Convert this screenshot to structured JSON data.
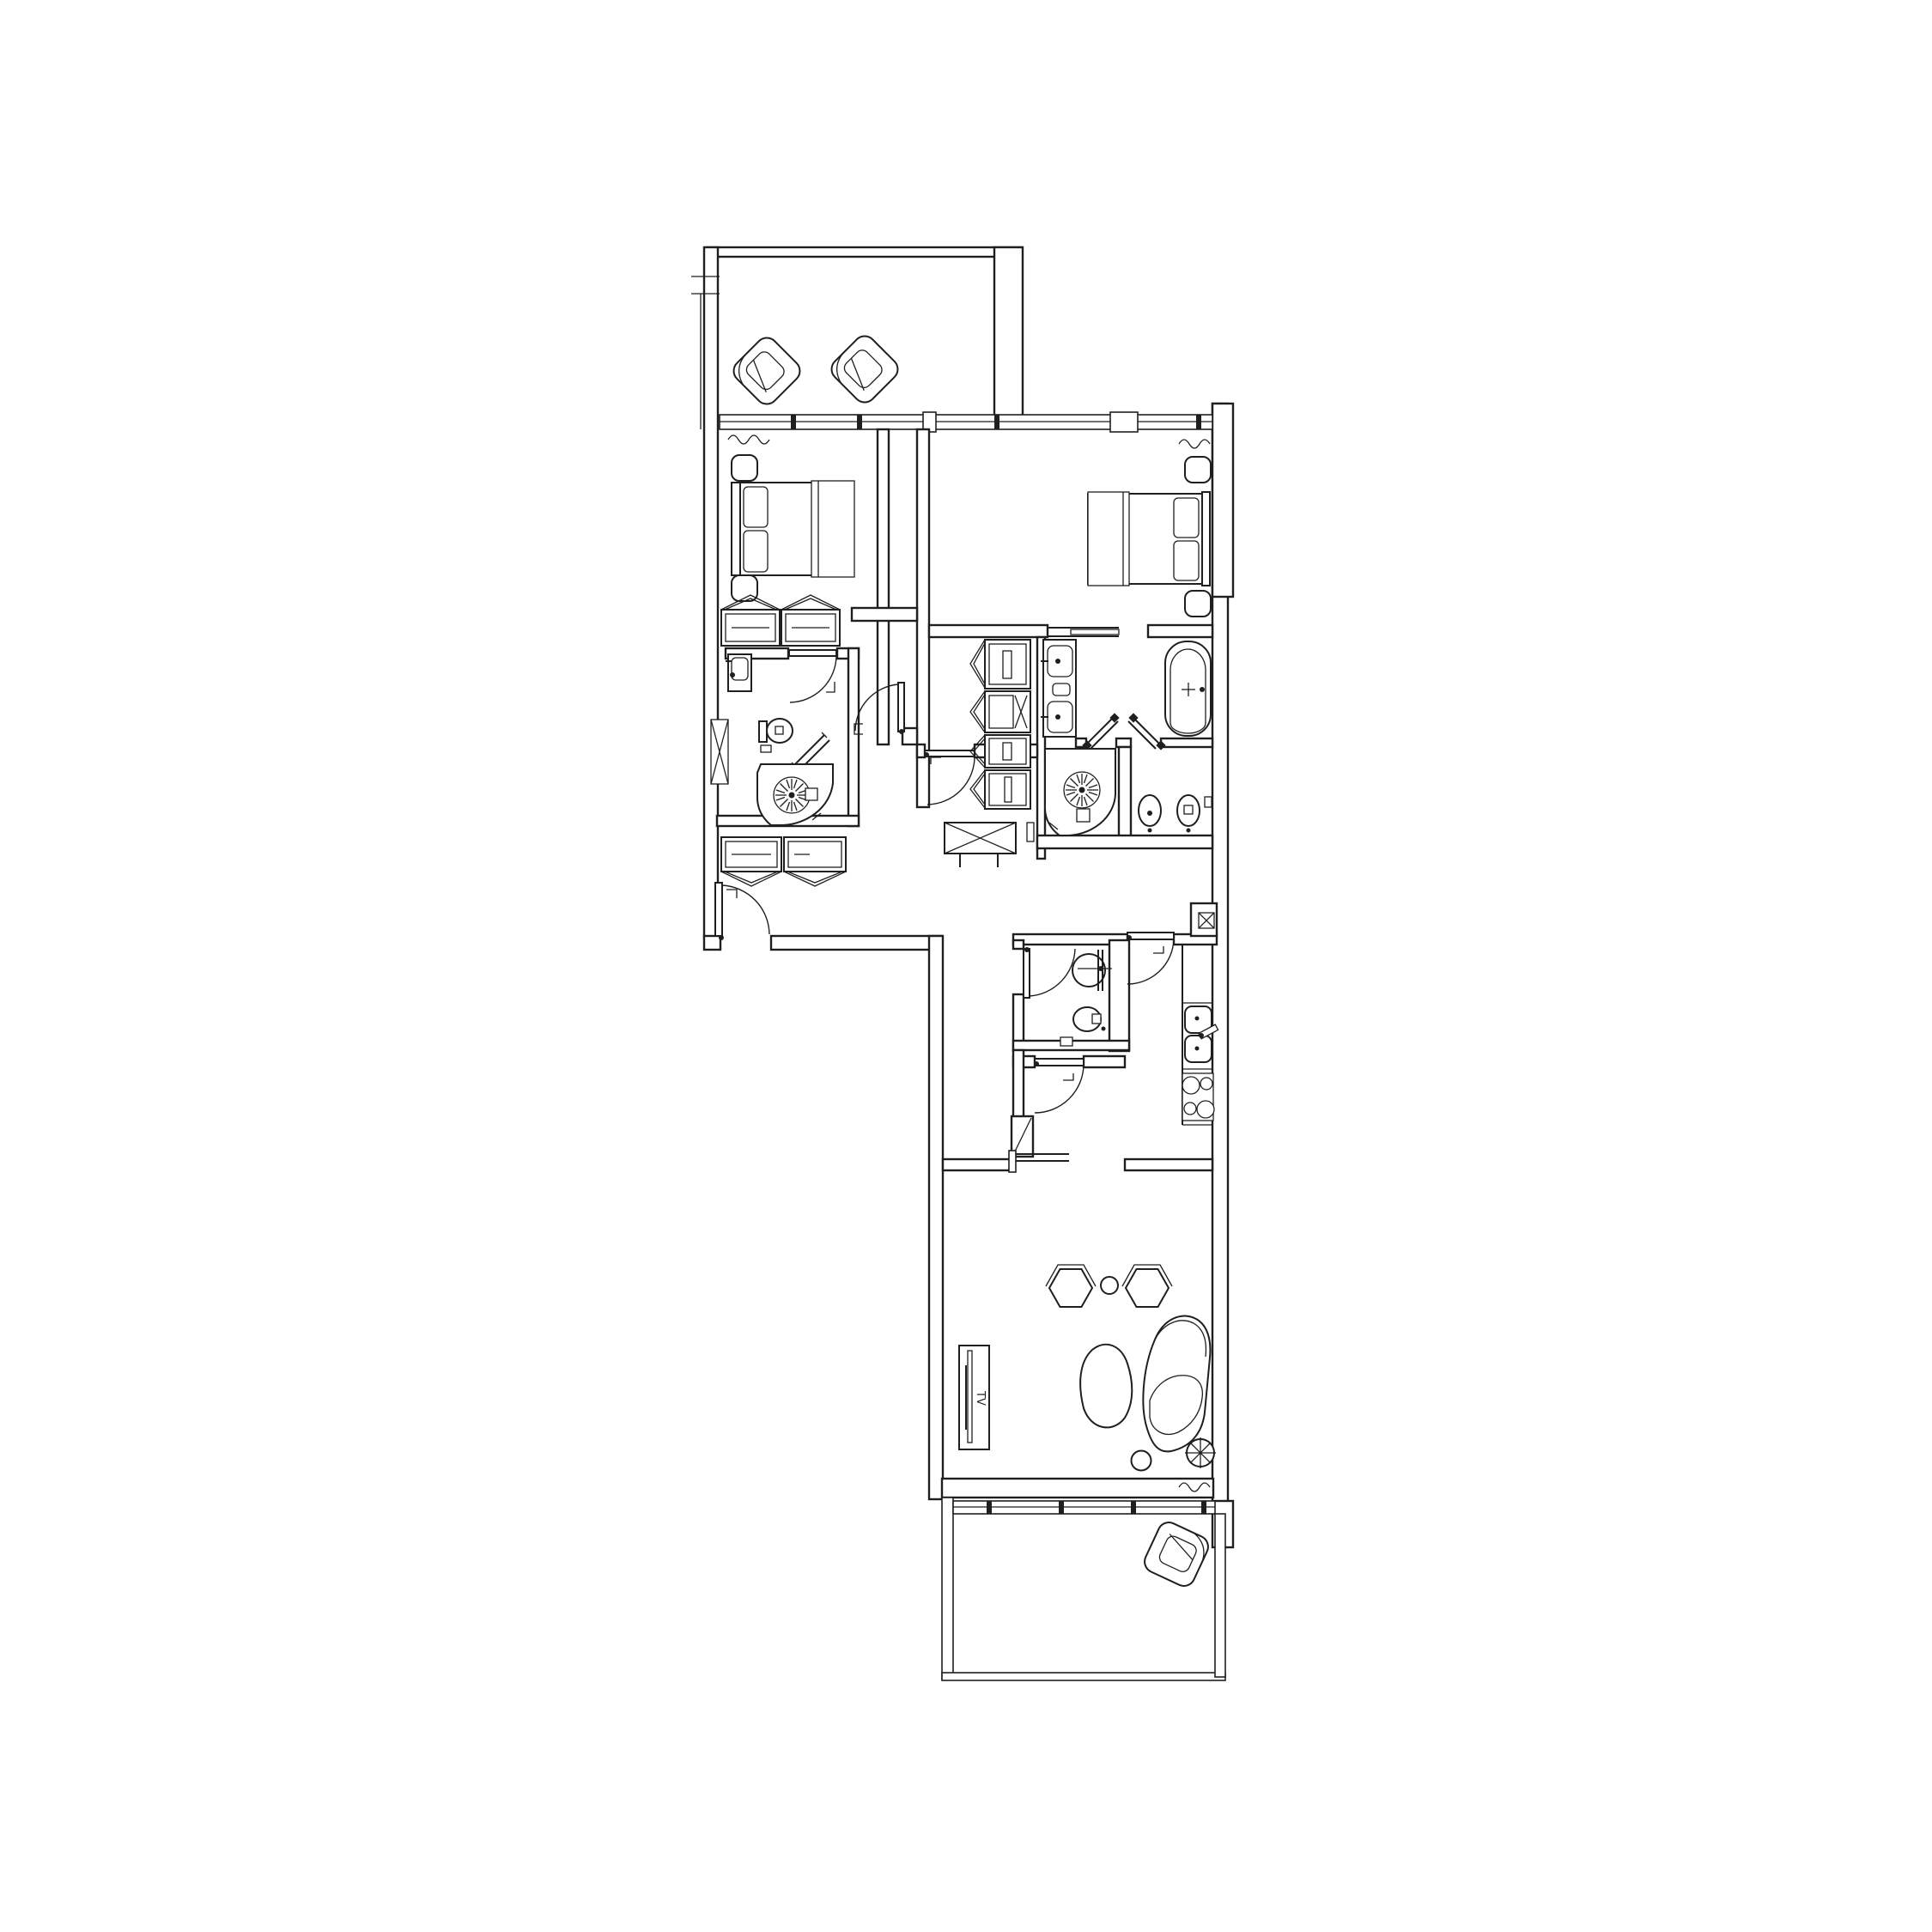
{
  "document": {
    "type": "architectural-floor-plan",
    "visible_text": {
      "tv_label": "TV"
    },
    "colors": {
      "ink": "#1f1f1f",
      "paper": "#ffffff"
    },
    "rooms": [
      "upper-terrace",
      "bedroom-left",
      "bedroom-right",
      "ensuite-left",
      "walkthrough-closet",
      "main-bathroom",
      "wc-room",
      "hallway",
      "guest-wc",
      "kitchen",
      "living-room",
      "lower-balcony"
    ],
    "furniture_icons": [
      "lounge-chair-icon",
      "double-bed-icon",
      "nightstand-icon",
      "wardrobe-icon",
      "washbasin-icon",
      "toilet-icon",
      "bidet-icon",
      "round-shower-icon",
      "bathtub-icon",
      "double-vanity-icon",
      "luggage-bench-icon",
      "entry-door-icon",
      "swing-door-icon",
      "sliding-door-icon",
      "kitchen-sink-icon",
      "cooktop-icon",
      "tv-bench-icon",
      "hex-side-table-icon",
      "coffee-table-icon",
      "curved-sofa-icon",
      "pouf-icon",
      "ceiling-fan-symbol",
      "shaft-x-symbol",
      "curtain-squiggle"
    ]
  }
}
